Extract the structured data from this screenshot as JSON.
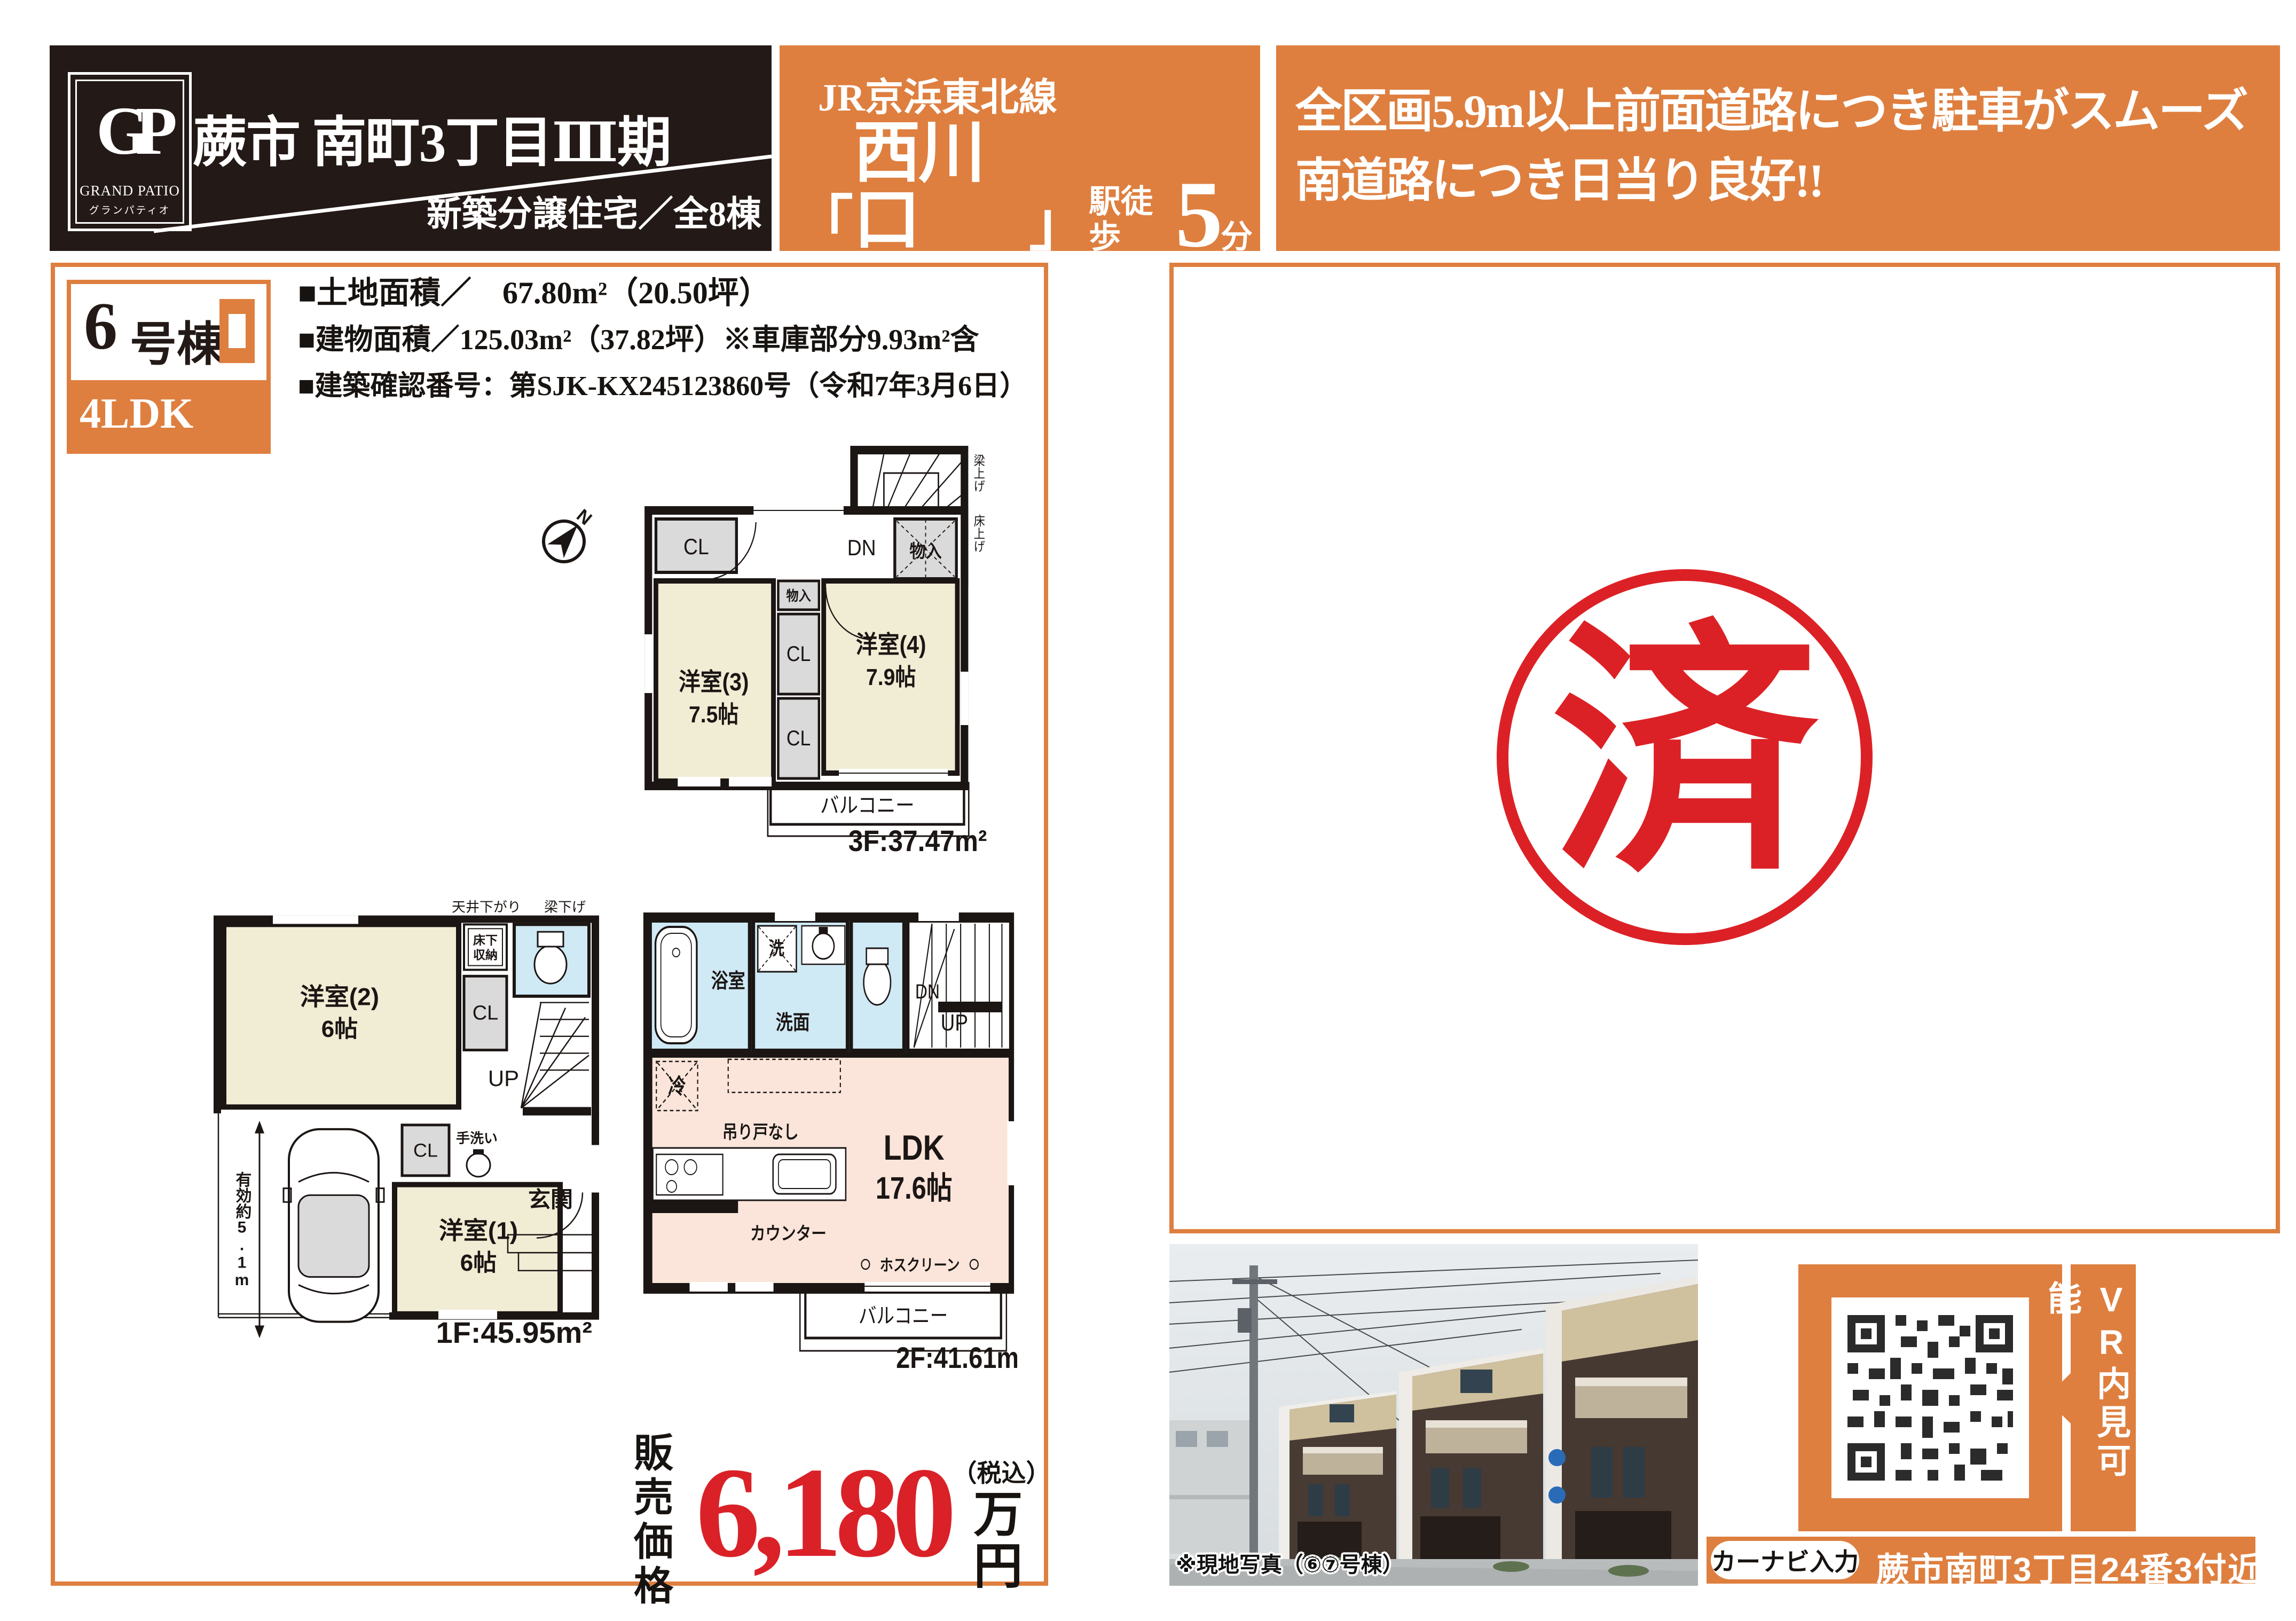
{
  "header": {
    "logo": {
      "monogram": "GP",
      "name": "GRAND PATIO",
      "kana": "グランパティオ"
    },
    "title": "蕨市 南町3丁目Ⅲ期",
    "subtitle": "新築分譲住宅／全8棟",
    "station": {
      "line": "JR京浜東北線",
      "bracket_open": "「",
      "name": "西川口",
      "bracket_close": "」",
      "walk": "駅徒歩",
      "minutes": "5",
      "unit": "分"
    },
    "catch": {
      "line1": "全区画5.9m以上前面道路につき駐車がスムーズ",
      "line2": "南道路につき日当り良好!!"
    }
  },
  "property": {
    "unit_number": "6",
    "unit_suffix": "号棟",
    "layout": "4LDK",
    "land": "■土地面積／　67.80m²（20.50坪）",
    "building": "■建物面積／125.03m²（37.82坪）※車庫部分9.93m²含",
    "permit": "■建築確認番号：第SJK-KX245123860号（令和7年3月6日）"
  },
  "compass": {
    "n": "N"
  },
  "plan3f": {
    "room3": "洋室(3)",
    "room3_size": "7.5帖",
    "room4": "洋室(4)",
    "room4_size": "7.9帖",
    "cl": "CL",
    "storage": "物入",
    "dn": "DN",
    "balcony": "バルコニー",
    "area": "3F:37.47m²",
    "note_beam": "梁上げ",
    "note_floor": "床上げ"
  },
  "plan1f": {
    "room2": "洋室(2)",
    "room2_size": "6帖",
    "room1": "洋室(1)",
    "room1_size": "6帖",
    "underfloor1": "床下",
    "underfloor2": "収納",
    "cl": "CL",
    "up": "UP",
    "handwash": "手洗い",
    "entrance": "玄関",
    "garage_note": "有効約5.1m",
    "note_ceiling": "天井下がり",
    "note_beam": "梁下げ",
    "area": "1F:45.95m²"
  },
  "plan2f": {
    "bath": "浴室",
    "washer": "洗",
    "washroom": "洗面",
    "dn": "DN",
    "up": "UP",
    "fridge": "冷",
    "no_cupboard": "吊り戸なし",
    "counter": "カウンター",
    "ldk": "LDK",
    "ldk_size": "17.6帖",
    "hoscreen": "ホスクリーン",
    "balcony": "バルコニー",
    "area": "2F:41.61m²"
  },
  "price": {
    "label_line1": "販売",
    "label_line2": "価格",
    "amount": "6,180",
    "tax_note": "（税込）",
    "unit": "万円"
  },
  "stamp": {
    "char": "済"
  },
  "photo": {
    "caption": "※現地写真（⑥⑦号棟）"
  },
  "vr": {
    "label": "VR内見可能"
  },
  "navi": {
    "label": "カーナビ入力",
    "address": "蕨市南町3丁目24番3付近"
  },
  "colors": {
    "orange": "#de7f3f",
    "red": "#da2128",
    "header_black": "#231916",
    "room_beige": "#f1ecd4",
    "ldk_pink": "#fbe5da",
    "wet_blue": "#cfe9f5",
    "closet_gray": "#dadada"
  }
}
